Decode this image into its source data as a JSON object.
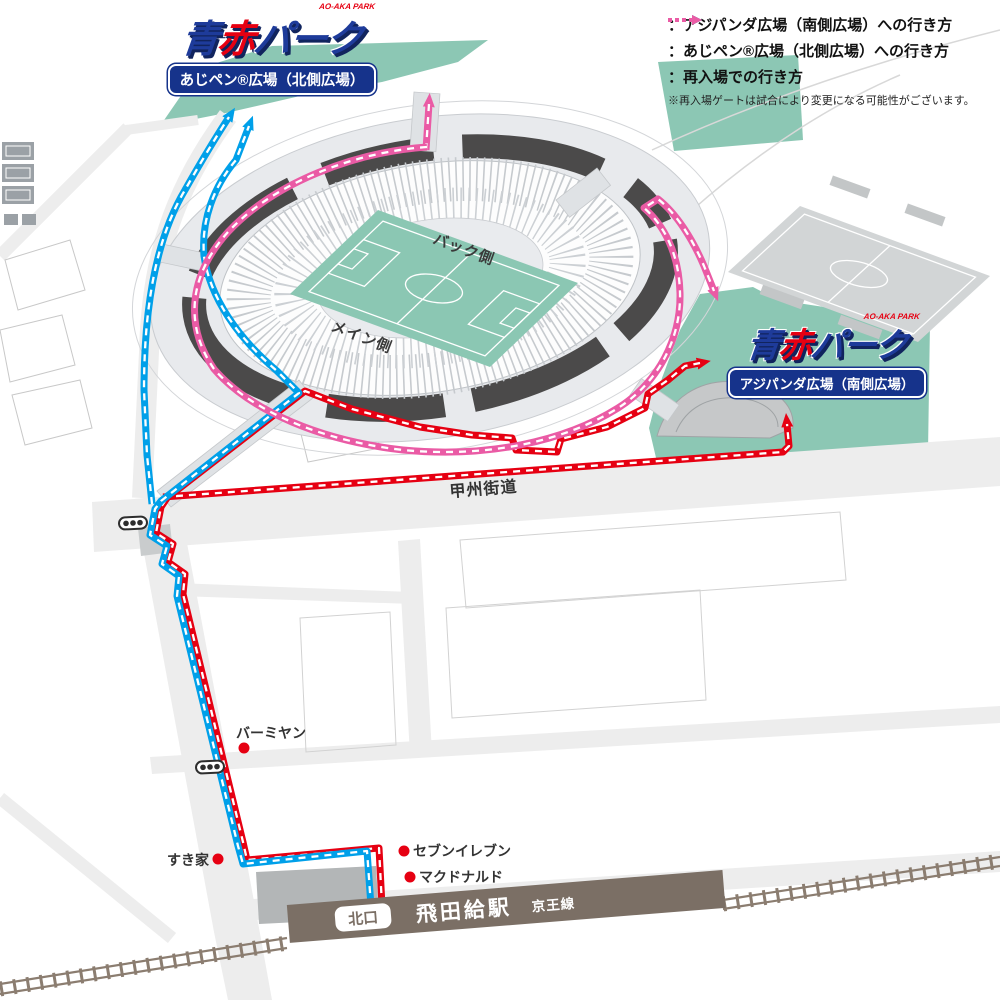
{
  "legend": {
    "items": [
      {
        "name": "route-south-plaza",
        "color": "#e60012",
        "label": "：アジパンダ広場（南側広場）への行き方"
      },
      {
        "name": "route-north-plaza",
        "color": "#00a0e9",
        "label": "：あじペン®広場（北側広場）への行き方"
      },
      {
        "name": "route-reentry",
        "color": "#ea5ba5",
        "label": "：再入場での行き方"
      }
    ],
    "note": "※再入場ゲートは試合により変更になる可能性がございます。"
  },
  "logo": {
    "ao": "青",
    "aka": "赤",
    "park": "パーク",
    "sub": "AO-AKA PARK"
  },
  "plazas": {
    "north_label": "あじペン®広場（北側広場）",
    "south_label": "アジパンダ広場（南側広場）"
  },
  "stadium": {
    "back": "バック側",
    "main": "メイン側"
  },
  "road": {
    "koshu": "甲州街道"
  },
  "pois": {
    "bamiyan": "バーミヤン",
    "sukiya": "すき家",
    "seven": "セブンイレブン",
    "mcdonalds": "マクドナルド"
  },
  "station": {
    "exit": "北口",
    "name": "飛田給駅",
    "line": "京王線"
  },
  "colors": {
    "route_south": "#e60012",
    "route_north": "#00a0e9",
    "route_reentry": "#ea5ba5",
    "plaza_green": "#8cc7b4",
    "pitch_green": "#8bc7b3",
    "stadium_ring": "#4b4a4a",
    "station_brown": "#7b6f65",
    "railway_brown": "#8b7d70",
    "road_gray": "#ededed"
  }
}
